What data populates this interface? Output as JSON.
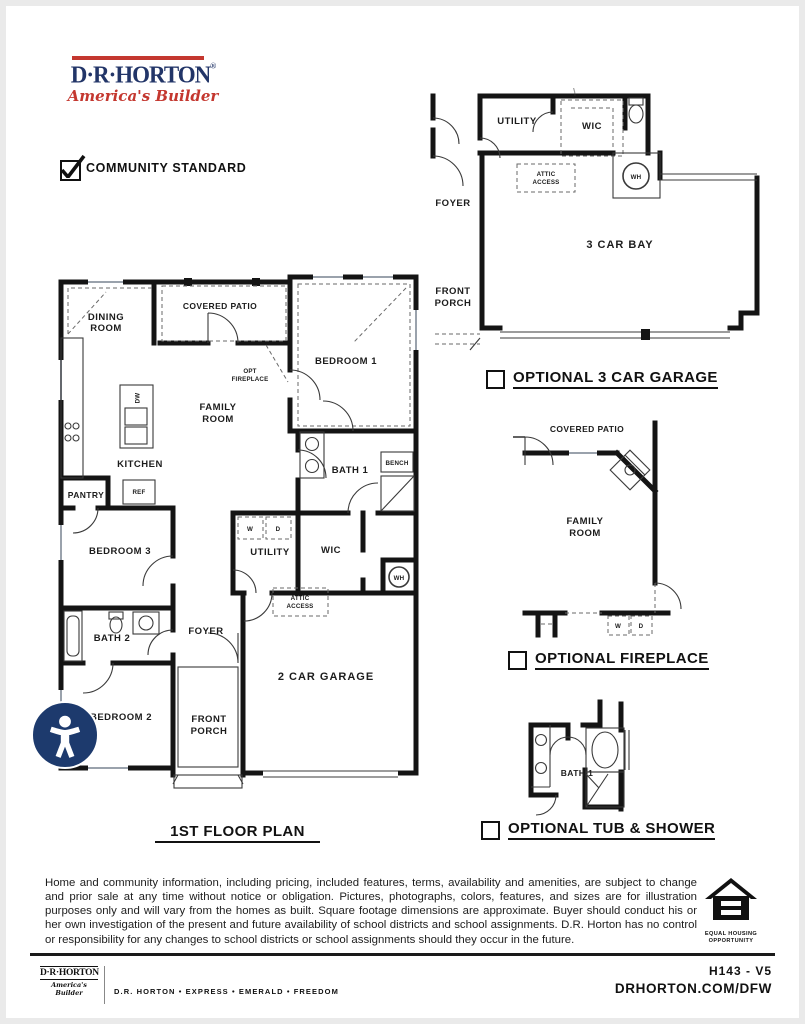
{
  "colors": {
    "brand_navy": "#223568",
    "brand_red": "#c4372f",
    "line_black": "#141414",
    "a11y_navy": "#1d3a6d"
  },
  "header": {
    "brand": {
      "name": "D·R·HORTON",
      "registered": "®",
      "tagline": "America's Builder"
    },
    "community_standard": "COMMUNITY STANDARD"
  },
  "main_plan": {
    "title": "1ST FLOOR PLAN",
    "labels": {
      "dining": [
        "DINING",
        "ROOM"
      ],
      "covered_patio": "COVERED PATIO",
      "bedroom1": "BEDROOM 1",
      "opt_fireplace": [
        "OPT",
        "FIREPLACE"
      ],
      "family": [
        "FAMILY",
        "ROOM"
      ],
      "kitchen": "KITCHEN",
      "dw": "DW",
      "ref": "REF",
      "pantry": "PANTRY",
      "bath1": "BATH 1",
      "bench": "BENCH",
      "bedroom3": "BEDROOM 3",
      "washer": "W",
      "dryer": "D",
      "utility": "UTILITY",
      "wic": "WIC",
      "water_heater": "WH",
      "attic": [
        "ATTIC",
        "ACCESS"
      ],
      "bath2": "BATH 2",
      "foyer": "FOYER",
      "bedroom2": "BEDROOM 2",
      "front_porch": [
        "FRONT",
        "PORCH"
      ],
      "garage": "2 CAR GARAGE"
    }
  },
  "optional_garage": {
    "caption": "OPTIONAL 3 CAR GARAGE",
    "labels": {
      "utility": "UTILITY",
      "wic": "WIC",
      "water_heater": "WH",
      "attic": [
        "ATTIC",
        "ACCESS"
      ],
      "foyer": "FOYER",
      "front_porch": [
        "FRONT",
        "PORCH"
      ],
      "bay": "3 CAR BAY"
    }
  },
  "optional_fireplace": {
    "caption": "OPTIONAL FIREPLACE",
    "labels": {
      "covered_patio": "COVERED PATIO",
      "family": [
        "FAMILY",
        "ROOM"
      ],
      "washer": "W",
      "dryer": "D"
    }
  },
  "optional_tub": {
    "caption": "OPTIONAL TUB & SHOWER",
    "labels": {
      "bath1": "BATH 1"
    }
  },
  "disclaimer": "Home and community information, including pricing, included features, terms, availability and amenities, are subject to change and prior sale at any time without notice or obligation. Pictures, photographs, colors, features, and sizes are for illustration purposes only and will vary from the homes as built. Square footage dimensions are approximate. Buyer should conduct his or her own investigation of the present and future availability of school districts and school assignments. D.R. Horton has no control or responsibility for any changes to school districts or school assignments should they occur in the future.",
  "eho": {
    "lines": [
      "EQUAL HOUSING",
      "OPPORTUNITY"
    ]
  },
  "footer": {
    "brand": "D·R·HORTON",
    "tagline": "America's Builder",
    "series": "D.R. HORTON  •  EXPRESS  •  EMERALD  •  FREEDOM",
    "plan_code": "H143 - V5",
    "website": "DRHORTON.COM/DFW"
  }
}
